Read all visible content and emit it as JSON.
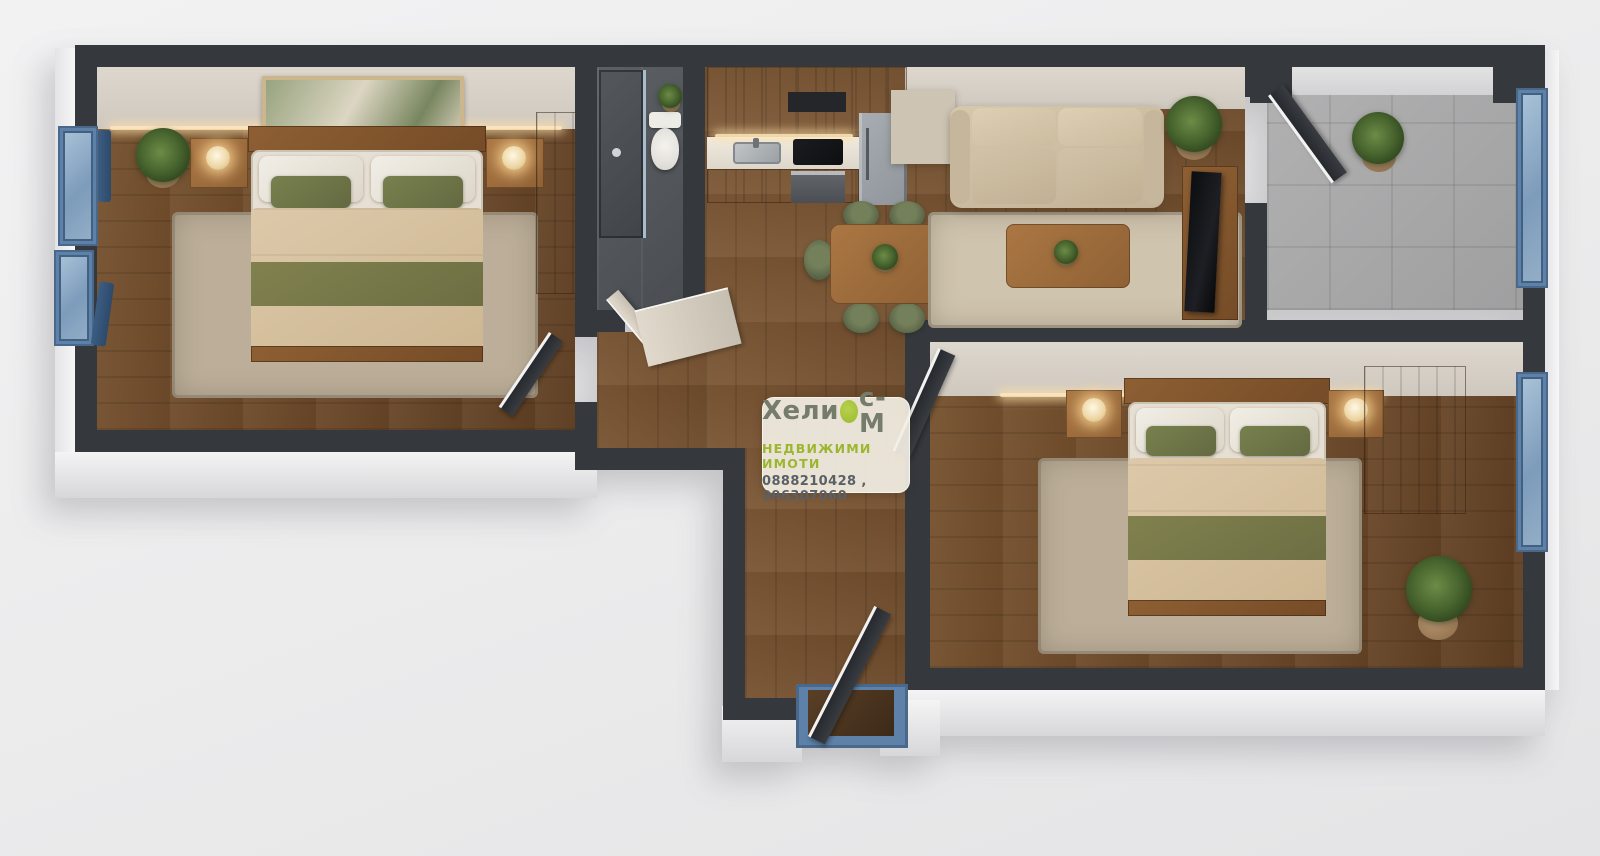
{
  "scene_type": "3d-apartment-floor-plan-render",
  "watermark": {
    "brand_full": "Хелиос-М",
    "brand_prefix": "Хели",
    "brand_suffix": "с-М",
    "subtitle": "НЕДВИЖИМИ ИМОТИ",
    "phones": "0888210428 , 096307060"
  },
  "palette": {
    "background": "#ededee",
    "wall_top": "#35383d",
    "wall_exterior": "#e9e9ea",
    "wood_floor": "#74502f",
    "bedroom_rug": "#bcae98",
    "bed_blanket_beige": "#d5c1a1",
    "accent_olive_green": "#6e7347",
    "sofa_beige": "#cfc0a6",
    "window_frame_blue": "#5d81a8",
    "balcony_tile_gray": "#a8a8a9",
    "bathroom_tile_dark": "#53575b",
    "brand_green": "#9cba2e",
    "brand_text_gray": "#757c6c",
    "phone_text_gray": "#5a6065"
  }
}
